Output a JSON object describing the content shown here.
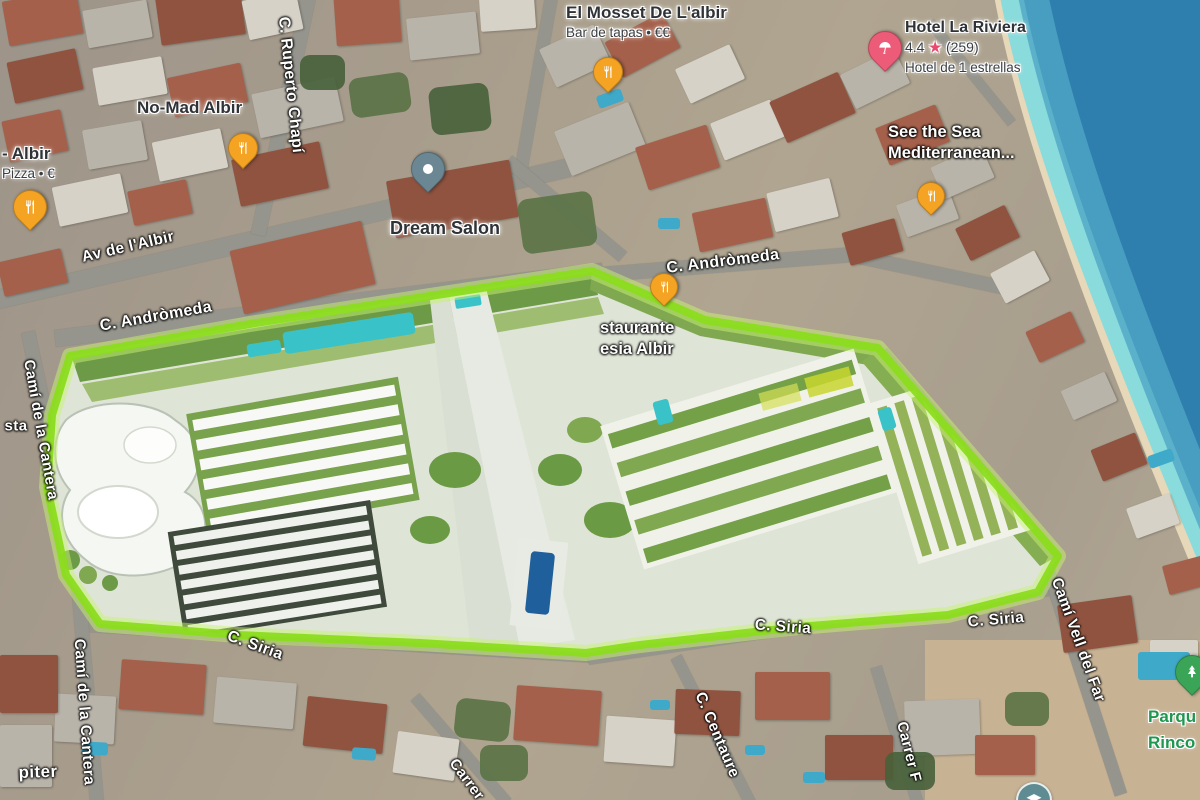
{
  "colors": {
    "site_outline_green": "#8bdc1e",
    "sea_deep": "#2e7fae",
    "sea_shallow": "#7fd0d6",
    "beach_sand": "#e6d8b8",
    "pool_teal": "#39c2c8",
    "pin_restaurant_orange": "#f4a322",
    "pin_hotel_pink": "#ec5b77",
    "pin_place_slate": "#6b8793",
    "pin_park_green": "#3ba557",
    "school_badge_teal": "#5e8c92",
    "park_text_green": "#1e9750"
  },
  "icons": {
    "restaurant": "fork-knife",
    "hotel": "beach-umbrella",
    "place": "white-dot",
    "park": "pine-tree",
    "school": "mortarboard"
  },
  "pois": {
    "el_mosset": {
      "title": "El Mosset De L'albir",
      "subtitle": "Bar de tapas • €€"
    },
    "no_mad": {
      "title": "No-Mad Albir"
    },
    "pizza": {
      "title": "- Albir",
      "subtitle": "Pizza • €"
    },
    "hotel": {
      "title": "Hotel La Riviera",
      "rating": "4.4",
      "star": "★",
      "reviews": "(259)",
      "subtitle": "Hotel de 1 estrellas"
    },
    "see_the_sea": {
      "line1": "See the Sea",
      "line2": "Mediterranean..."
    },
    "dream_salon": {
      "title": "Dream Salon"
    },
    "restaurante": {
      "line1": "staurante",
      "line2": "esia Albir"
    },
    "park": {
      "line1": "Parqu",
      "line2": "Rinco"
    }
  },
  "streets": {
    "ruperto_chapi": "C. Ruperto Chapí",
    "av_albir": "Av de l'Albir",
    "andromeda_top": "C. Andròmeda",
    "andromeda_left": "C. Andròmeda",
    "cantera_upper": "Camí de la Cantera",
    "cantera_lower": "Camí de la Cantera",
    "sta_fragment": "sta",
    "siria_left": "C. Siria",
    "siria_mid": "C. Siria",
    "siria_right": "C. Siria",
    "cami_vell_del_far": "Camí Vell del Far",
    "centaure": "C. Centaure",
    "carrer_f": "Carrer F",
    "carrer_bottom": "Carrer",
    "piter_fragment": "piter"
  }
}
